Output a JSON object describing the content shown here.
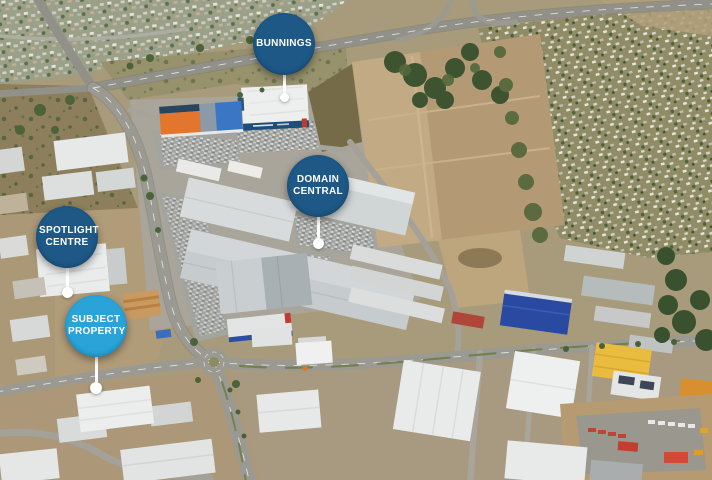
{
  "markers": [
    {
      "id": "bunnings",
      "label": "BUNNINGS",
      "color": "#1d5886"
    },
    {
      "id": "domain-central",
      "label": "DOMAIN CENTRAL",
      "color": "#1d5886"
    },
    {
      "id": "spotlight-centre",
      "label": "SPOTLIGHT CENTRE",
      "color": "#1d5886"
    },
    {
      "id": "subject-property",
      "label": "SUBJECT PROPERTY",
      "color": "#29a3d8"
    }
  ],
  "colors": {
    "marker_dark_blue": "#1d5886",
    "marker_light_blue": "#29a3d8",
    "marker_text": "#ffffff",
    "marker_stem": "#ffffff"
  }
}
